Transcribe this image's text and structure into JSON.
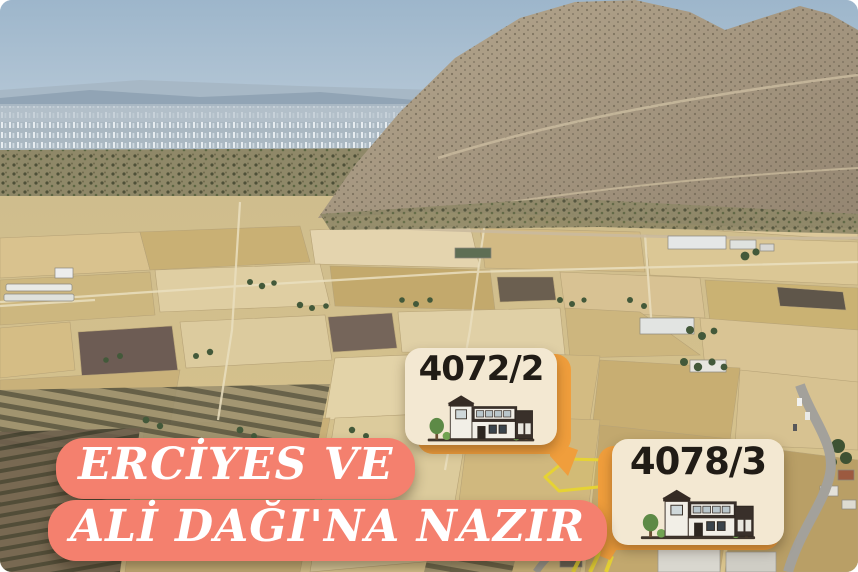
{
  "parcels": [
    {
      "number": "4072/2"
    },
    {
      "number": "4078/3"
    }
  ],
  "caption": {
    "line1": "ERCİYES VE",
    "line2": "ALİ DAĞI'NA NAZIR"
  },
  "colors": {
    "caption_background": "#F4806E",
    "caption_text": "#FFFFFF",
    "card_background": "#F3E8D2",
    "card_accent_orange": "#F09E3C",
    "card_text": "#211C16",
    "plot_outline_yellow": "#E6D333"
  },
  "icons": {
    "house_icon": "two-story villa illustration",
    "tree_icon": "green tree"
  }
}
